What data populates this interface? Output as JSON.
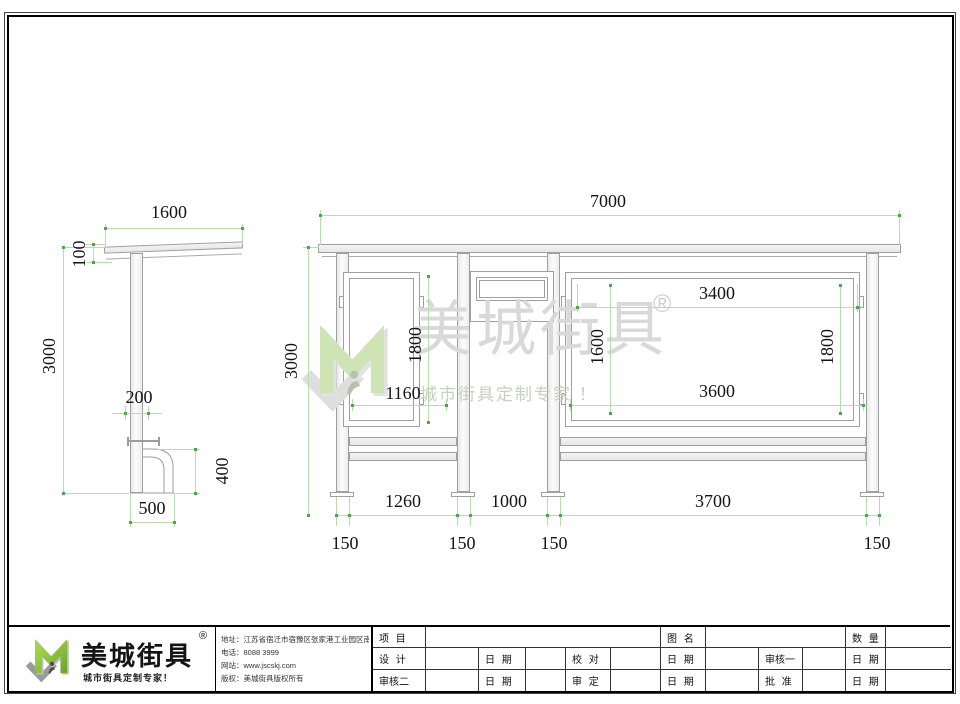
{
  "watermark": {
    "brand": "美城街具",
    "reg": "®",
    "slogan": "城市街具定制专家 ！"
  },
  "views": {
    "side": {
      "dims": {
        "roof_width": "1600",
        "roof_thickness": "100",
        "total_height": "3000",
        "column_width": "200",
        "bench_height": "400",
        "base_width": "500"
      }
    },
    "front": {
      "dims": {
        "total_width": "7000",
        "total_height": "3000",
        "left_panel_height": "1800",
        "left_panel_width": "1160",
        "board_width_top": "3400",
        "board_height_left": "1600",
        "board_height_right": "1800",
        "board_width_bottom": "3600",
        "bay_left": "1260",
        "bay_middle": "1000",
        "bay_right": "3700",
        "footing_offsets": [
          "150",
          "150",
          "150",
          "150"
        ]
      }
    }
  },
  "title_block": {
    "logo": {
      "brand": "美城街具",
      "reg": "®",
      "slogan": "城市街具定制专家！"
    },
    "company": {
      "address": "地址：江苏省宿迁市宿豫区张家港工业园区南丰路西侧1号",
      "phone": "电话：8088 3999",
      "website": "网站：www.jscskj.com",
      "copyright": "版权：美城街具版权所有"
    },
    "table": {
      "project_label": "项 目",
      "drawing_label": "图 名",
      "qty_label": "数 量",
      "design_label": "设 计",
      "date_label": "日 期",
      "check_label": "校 对",
      "review1_label": "审核一",
      "review2_label": "审核二",
      "approve_label": "审 定",
      "ratify_label": "批 准"
    }
  },
  "colors": {
    "dimension_green": "#b8dcab",
    "logo_green": "#8dc63f"
  }
}
